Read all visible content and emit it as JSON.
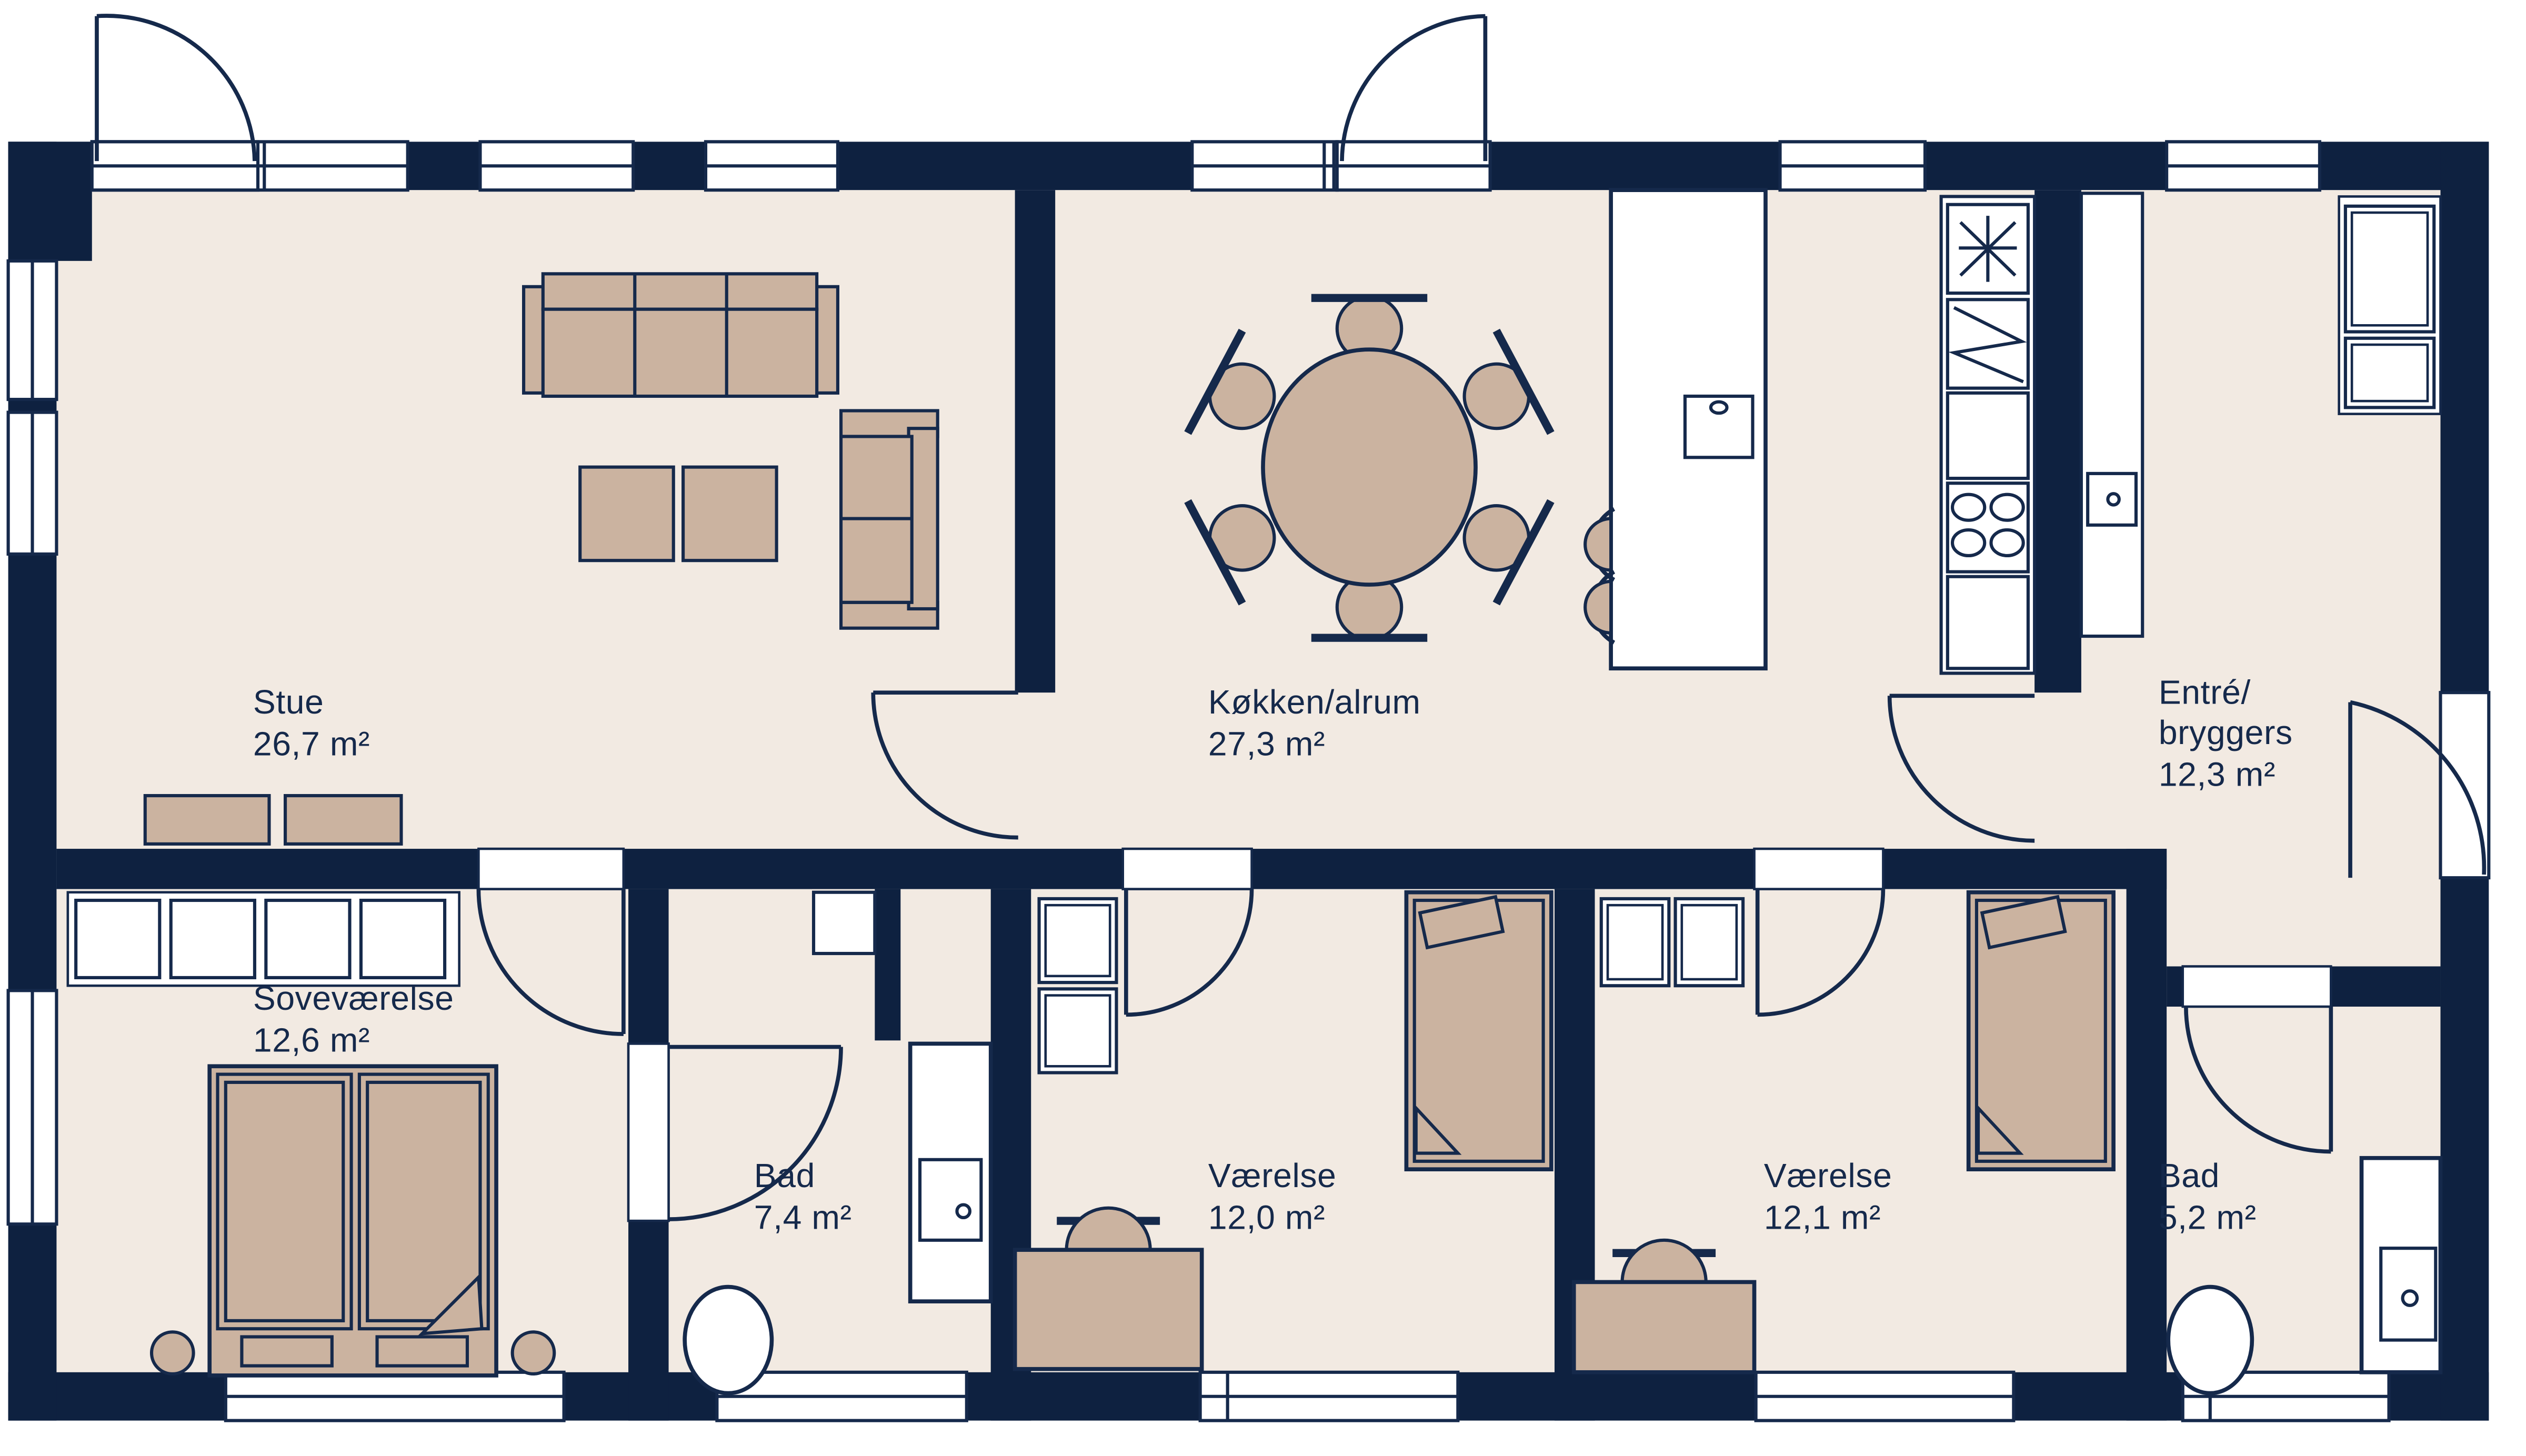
{
  "title": "Floor plan",
  "colors": {
    "wall_navy": "#0e2140",
    "floor_beige": "#f2eae2",
    "furniture_tan": "#cbb3a0",
    "fixture_white": "#ffffff",
    "text_navy": "#15294b"
  },
  "rooms": [
    {
      "id": "stue",
      "name_lines": [
        "Stue"
      ],
      "area": "26,7 m²"
    },
    {
      "id": "kokken-alrum",
      "name_lines": [
        "Køkken/alrum"
      ],
      "area": "27,3 m²"
    },
    {
      "id": "entre-bryggers",
      "name_lines": [
        "Entré/",
        "bryggers"
      ],
      "area": "12,3 m²"
    },
    {
      "id": "sovevaerelse",
      "name_lines": [
        "Soveværelse"
      ],
      "area": "12,6 m²"
    },
    {
      "id": "bad-1",
      "name_lines": [
        "Bad"
      ],
      "area": "7,4 m²"
    },
    {
      "id": "vaerelse-1",
      "name_lines": [
        "Værelse"
      ],
      "area": "12,0 m²"
    },
    {
      "id": "vaerelse-2",
      "name_lines": [
        "Værelse"
      ],
      "area": "12,1 m²"
    },
    {
      "id": "bad-2",
      "name_lines": [
        "Bad"
      ],
      "area": "5,2 m²"
    }
  ]
}
